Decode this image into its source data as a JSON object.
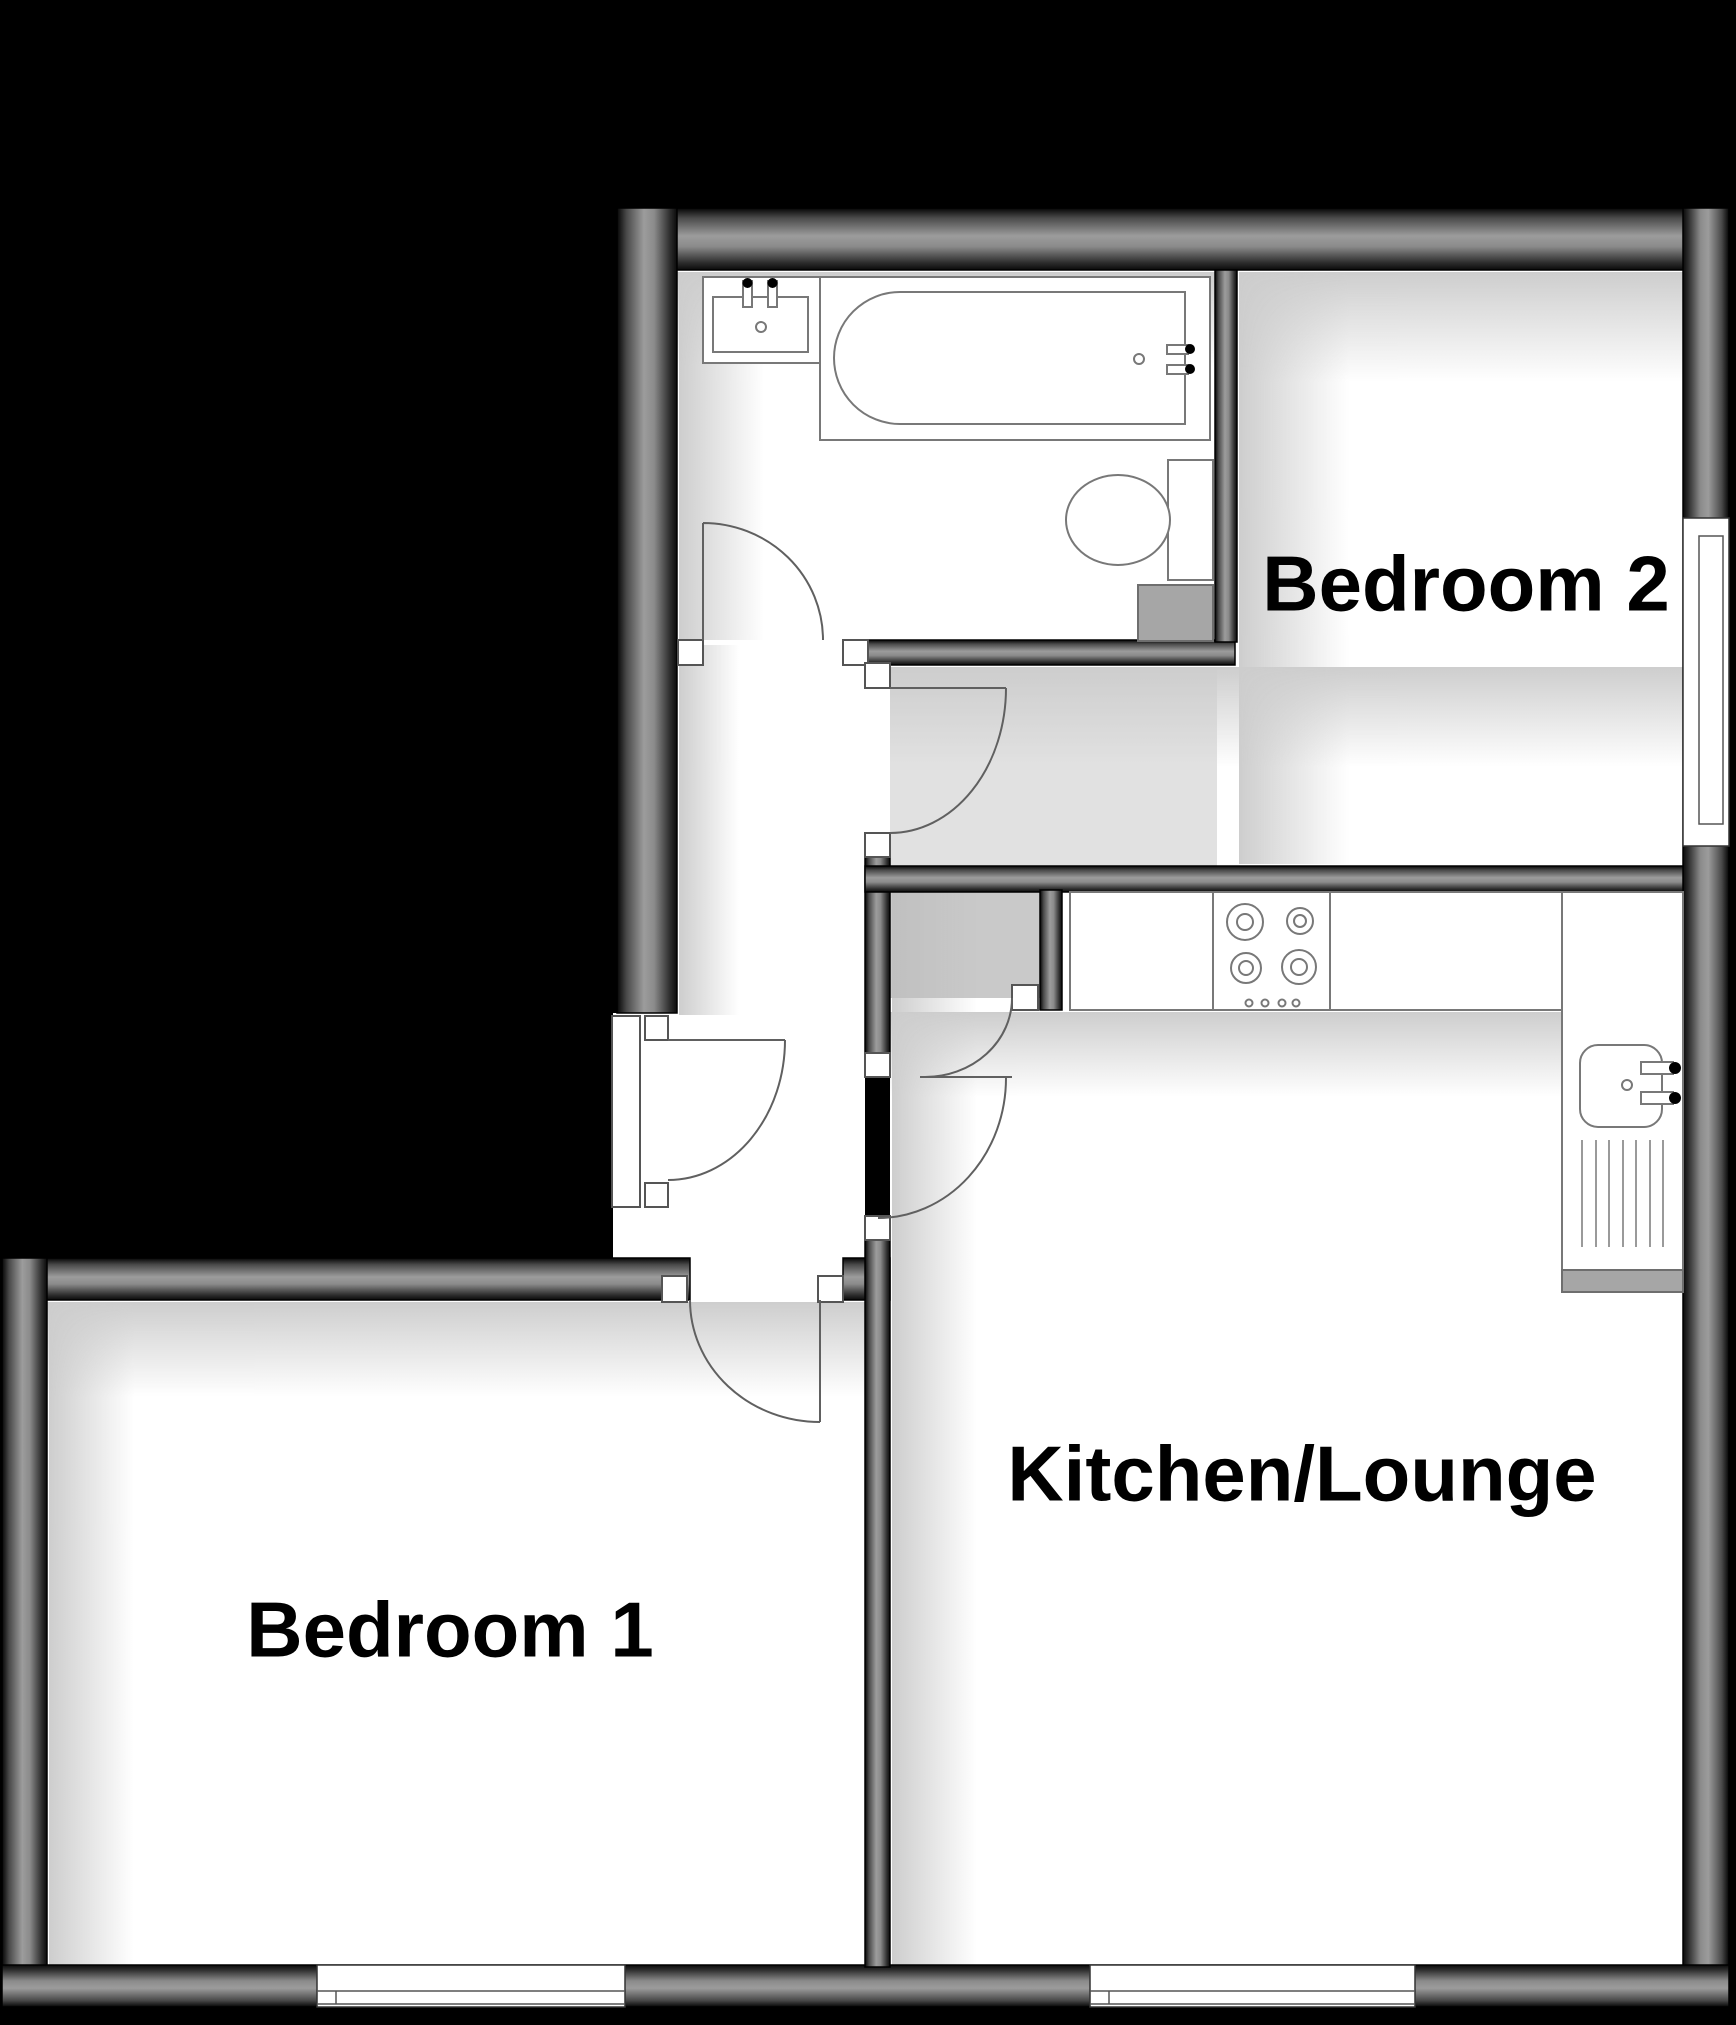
{
  "diagram": {
    "type": "floor-plan",
    "rooms": [
      {
        "id": "bedroom2",
        "label": "Bedroom 2"
      },
      {
        "id": "kitchen_lounge",
        "label": "Kitchen/Lounge"
      },
      {
        "id": "bedroom1",
        "label": "Bedroom 1"
      }
    ],
    "fixtures": [
      "bathroom-basin-with-taps",
      "bathtub-with-taps",
      "toilet-with-cistern",
      "boiler-unit",
      "storage-cupboard",
      "kitchen-worktop",
      "hob-4-burner",
      "kitchen-sink-with-taps",
      "drainer",
      "window-bedroom2-east",
      "window-bedroom1-south",
      "window-kitchen-south",
      "door-swings"
    ],
    "colors": {
      "background": "#000000",
      "wall_gray": "#969696",
      "floor": "#ffffff",
      "cupboard_floor": "#c9c9c9",
      "appliance_gray": "#a6a6a6",
      "fixture_line": "#787878",
      "label_text": "#000000"
    }
  }
}
